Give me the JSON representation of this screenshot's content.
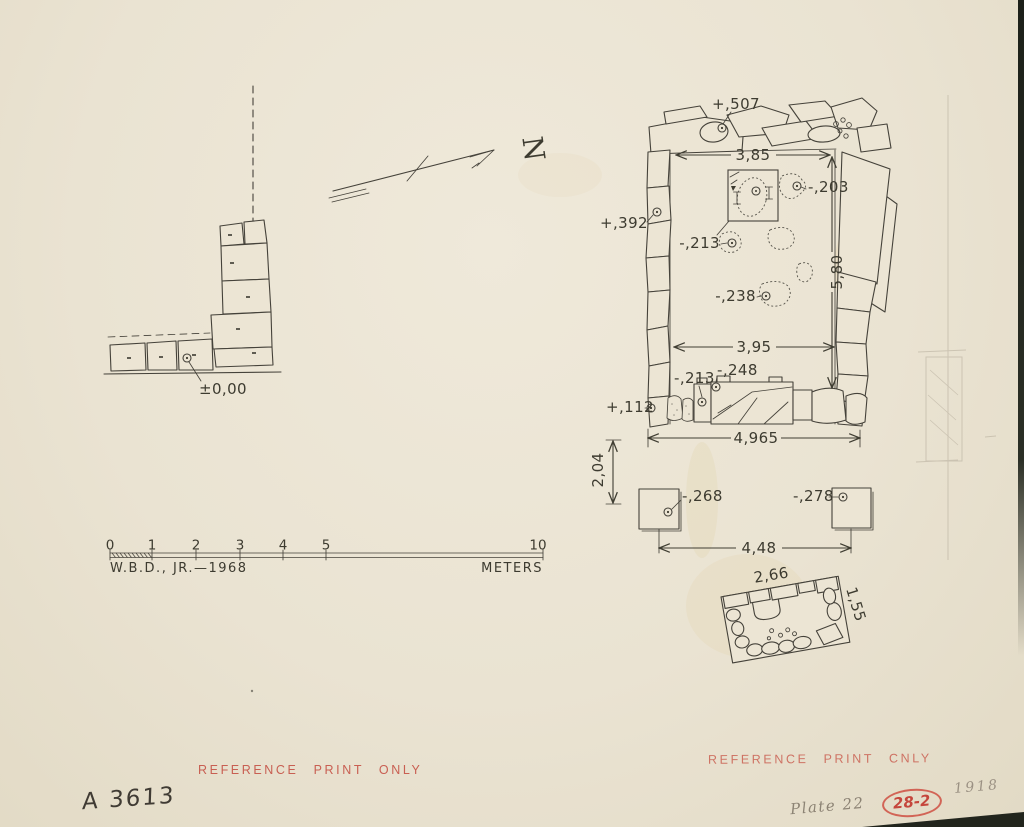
{
  "colors": {
    "paper": "#eae3d2",
    "ink": "#3d3b30",
    "pencil": "#8c8374",
    "stamp_red": "#c5564c"
  },
  "north_label": "N",
  "left_structure": {
    "datum": "±0,00"
  },
  "main": {
    "elev_top": "+,507",
    "dim_top": "3,85",
    "elev_ne": "-,203",
    "elev_west": "+,392",
    "elev_center_upper": "-,213",
    "dim_height": "5,80",
    "elev_center": "-,238",
    "dim_inner": "3,95",
    "elev_bench": "-,248",
    "elev_bench_left": "-,213",
    "elev_sw": "+,112",
    "dim_bottom": "4,965"
  },
  "pillars": {
    "dim_offset": "2,04",
    "elev_left": "-,268",
    "elev_right": "-,278",
    "dim_spacing": "4,48"
  },
  "slab": {
    "dim_width": "2,66",
    "dim_height": "1,55"
  },
  "scale_bar": {
    "ticks": [
      "0",
      "1",
      "2",
      "3",
      "4",
      "5",
      "10"
    ],
    "credit": "W.B.D., JR.—1968",
    "unit": "METERS"
  },
  "stamps": {
    "left": "REFERENCE PRINT ONLY",
    "right": "REFERENCE PRINT CNLY"
  },
  "annotations": {
    "catalog": "A 3613",
    "plate": "Plate 22",
    "stamp_no": "28-2",
    "year": "1918"
  }
}
